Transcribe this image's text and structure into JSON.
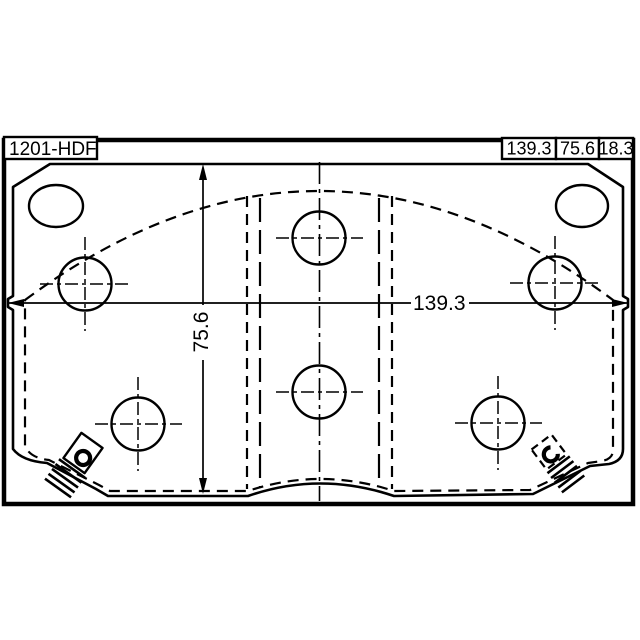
{
  "page": {
    "background_color": "#ffffff",
    "line_color": "#000000"
  },
  "part_label": {
    "text": "1201-HDF"
  },
  "spec_boxes": [
    {
      "name": "width",
      "value": "139.3"
    },
    {
      "name": "height",
      "value": "75.6"
    },
    {
      "name": "thickness",
      "value": "18.3"
    }
  ],
  "dimensions": {
    "width_label": "139.3",
    "height_label": "75.6"
  }
}
